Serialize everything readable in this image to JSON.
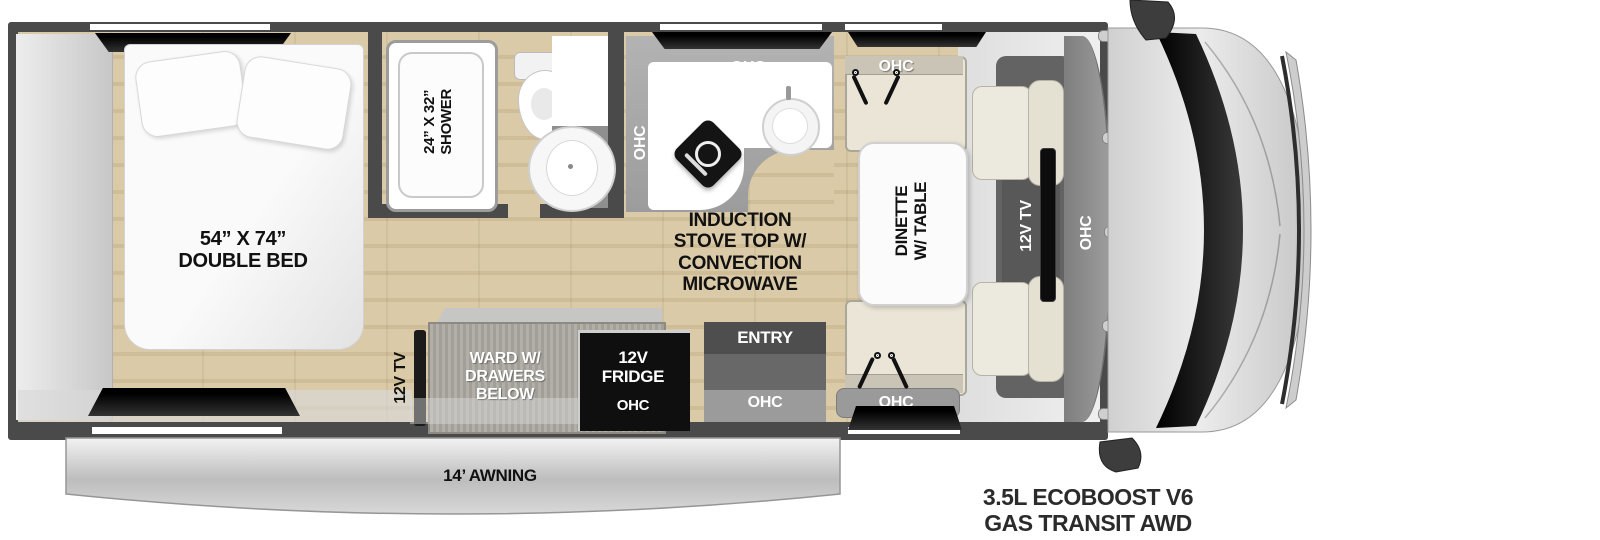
{
  "labels": {
    "bed": "54” X 74”\nDOUBLE BED",
    "shower": "24” X 32”\nSHOWER",
    "med": "MED",
    "kitchen_ohc_left": "OHC",
    "kitchen_ohc_top": "OHC",
    "stove": "INDUCTION\nSTOVE TOP W/\nCONVECTION\nMICROWAVE",
    "dinette_ohc_top": "OHC",
    "dinette_table": "DINETTE\nW/ TABLE",
    "dinette_ohc_bottom": "OHC",
    "cab_tv": "12V TV",
    "cab_ohc": "OHC",
    "bedroom_tv": "12V TV",
    "ward": "WARD W/\nDRAWERS\nBELOW",
    "fridge": "12V\nFRIDGE",
    "fridge_ohc": "OHC",
    "entry": "ENTRY",
    "entry_ohc": "OHC",
    "awning": "14’ AWNING",
    "engine": "3.5L ECOBOOST V6\nGAS TRANSIT AWD"
  },
  "colors": {
    "wall": "#4a4a4a",
    "floor_wood": "#d5c4a0",
    "counter_gray": "#a6a6a6",
    "fridge_black": "#0f0f0f",
    "awning_silver": "#c9c9c9",
    "cushion_beige": "#eae5d7"
  }
}
